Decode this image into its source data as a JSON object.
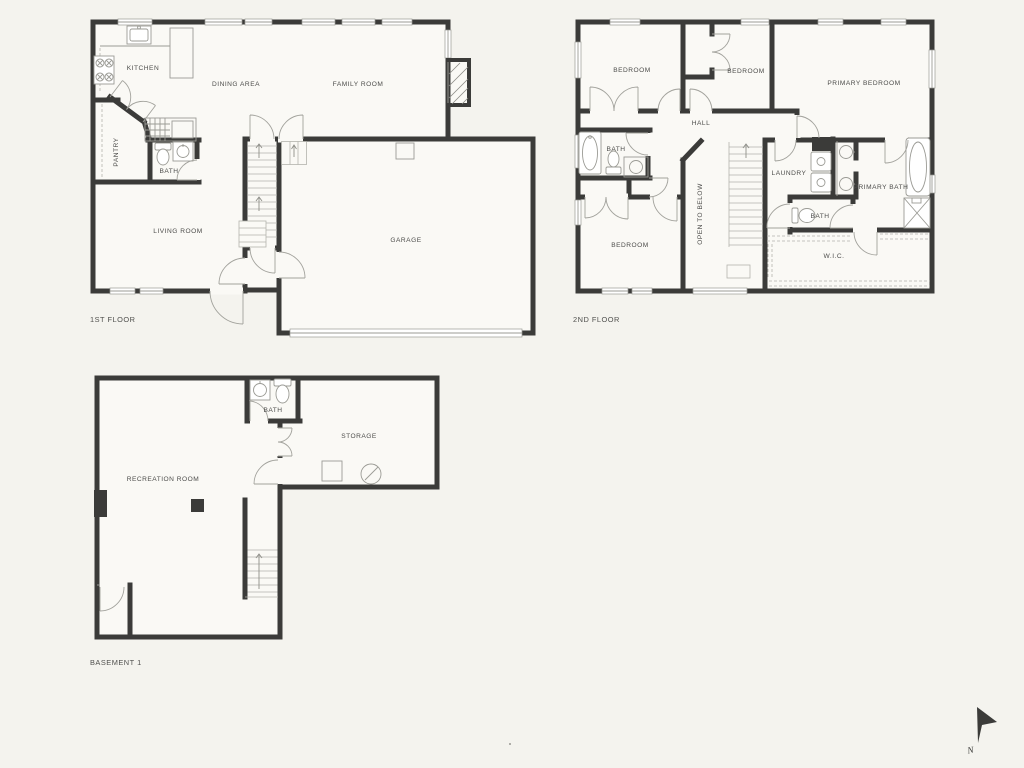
{
  "floor1": {
    "label": "1ST FLOOR",
    "rooms": {
      "kitchen": "KITCHEN",
      "dining_area": "DINING AREA",
      "family_room": "FAMILY ROOM",
      "pantry": "PANTRY",
      "bath": "BATH",
      "living_room": "LIVING ROOM",
      "garage": "GARAGE"
    }
  },
  "floor2": {
    "label": "2ND FLOOR",
    "rooms": {
      "bedroom_top_left": "BEDROOM",
      "bedroom_top_middle": "BEDROOM",
      "primary_bedroom": "PRIMARY BEDROOM",
      "hall": "HALL",
      "bath": "BATH",
      "laundry": "LAUNDRY",
      "primary_bath": "PRIMARY BATH",
      "bath_small": "BATH",
      "bedroom_bottom": "BEDROOM",
      "open_to_below": "OPEN TO BELOW",
      "wic": "W.I.C."
    }
  },
  "basement": {
    "label": "BASEMENT 1",
    "rooms": {
      "bath": "BATH",
      "storage": "STORAGE",
      "recreation_room": "RECREATION ROOM"
    }
  },
  "compass": {
    "north_label": "N"
  },
  "colors": {
    "background": "#f4f3ee",
    "room_fill": "#faf9f5",
    "wall": "#3b3b39",
    "fixture_line": "#9b9b95",
    "text": "#4d4d4b"
  }
}
